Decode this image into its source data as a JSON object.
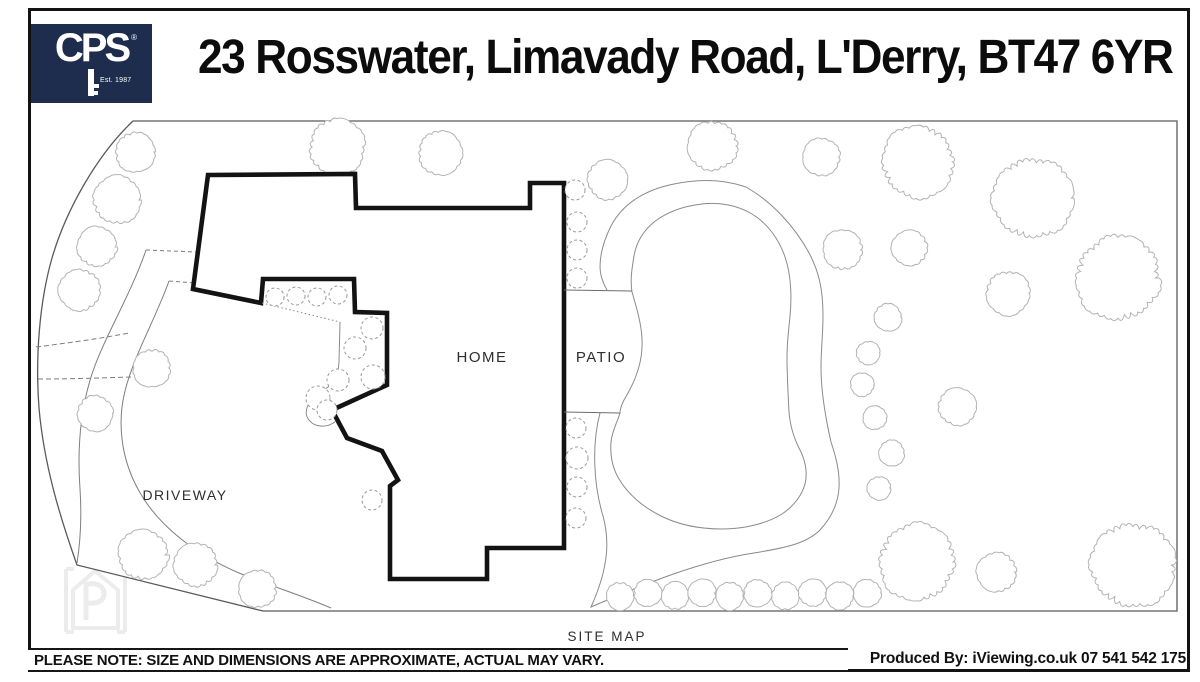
{
  "header": {
    "logo": {
      "brand": "CPS",
      "est": "Est. 1987",
      "registered": "®"
    },
    "title": "23 Rosswater, Limavady Road, L'Derry, BT47 6YR"
  },
  "map": {
    "labels": {
      "home": "HOME",
      "patio": "PATIO",
      "driveway": "DRIVEWAY",
      "site_map": "SITE MAP"
    }
  },
  "footer": {
    "disclaimer": "PLEASE NOTE: SIZE AND DIMENSIONS ARE APPROXIMATE, ACTUAL MAY VARY.",
    "produced_by": "Produced By: iViewing.co.uk 07 541 542 175"
  },
  "colors": {
    "brand_navy": "#1e2c4e",
    "house_line": "#131313",
    "boundary_line": "#5a5a5a",
    "garden_line": "#7d7d7d",
    "tree_line": "#b3b3b3",
    "watermark": "#ececec"
  }
}
